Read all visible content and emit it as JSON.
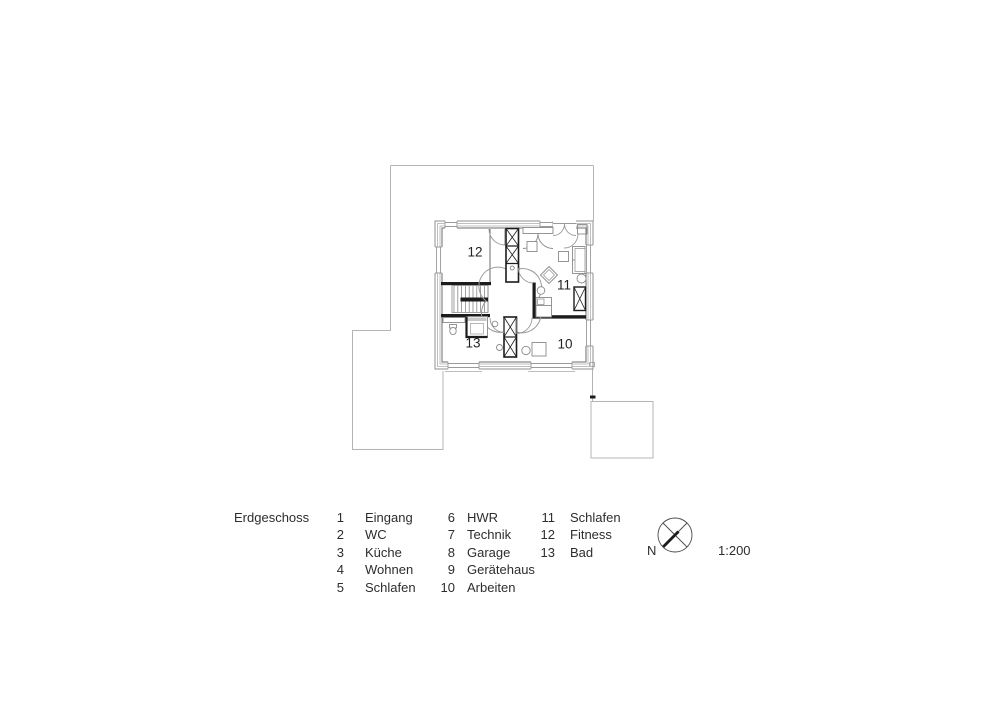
{
  "page": {
    "title": "Erdgeschoss",
    "scale_label": "1:200",
    "north_label": "N"
  },
  "colors": {
    "wall_black": "#1c1c1c",
    "drawing_gray": "#8a8a8a",
    "boundary_gray": "#b4b4b4",
    "text": "#2d2d2d"
  },
  "plan": {
    "rooms": [
      {
        "num": "12"
      },
      {
        "num": "11"
      },
      {
        "num": "13"
      },
      {
        "num": "10"
      }
    ]
  },
  "legend": {
    "columns": [
      {
        "items": [
          {
            "num": "1",
            "label": "Eingang"
          },
          {
            "num": "2",
            "label": "WC"
          },
          {
            "num": "3",
            "label": "Küche"
          },
          {
            "num": "4",
            "label": "Wohnen"
          },
          {
            "num": "5",
            "label": "Schlafen"
          }
        ]
      },
      {
        "items": [
          {
            "num": "6",
            "label": "HWR"
          },
          {
            "num": "7",
            "label": "Technik"
          },
          {
            "num": "8",
            "label": "Garage"
          },
          {
            "num": "9",
            "label": "Gerätehaus"
          },
          {
            "num": "10",
            "label": "Arbeiten"
          }
        ]
      },
      {
        "items": [
          {
            "num": "11",
            "label": "Schlafen"
          },
          {
            "num": "12",
            "label": "Fitness"
          },
          {
            "num": "13",
            "label": "Bad"
          }
        ]
      }
    ]
  }
}
